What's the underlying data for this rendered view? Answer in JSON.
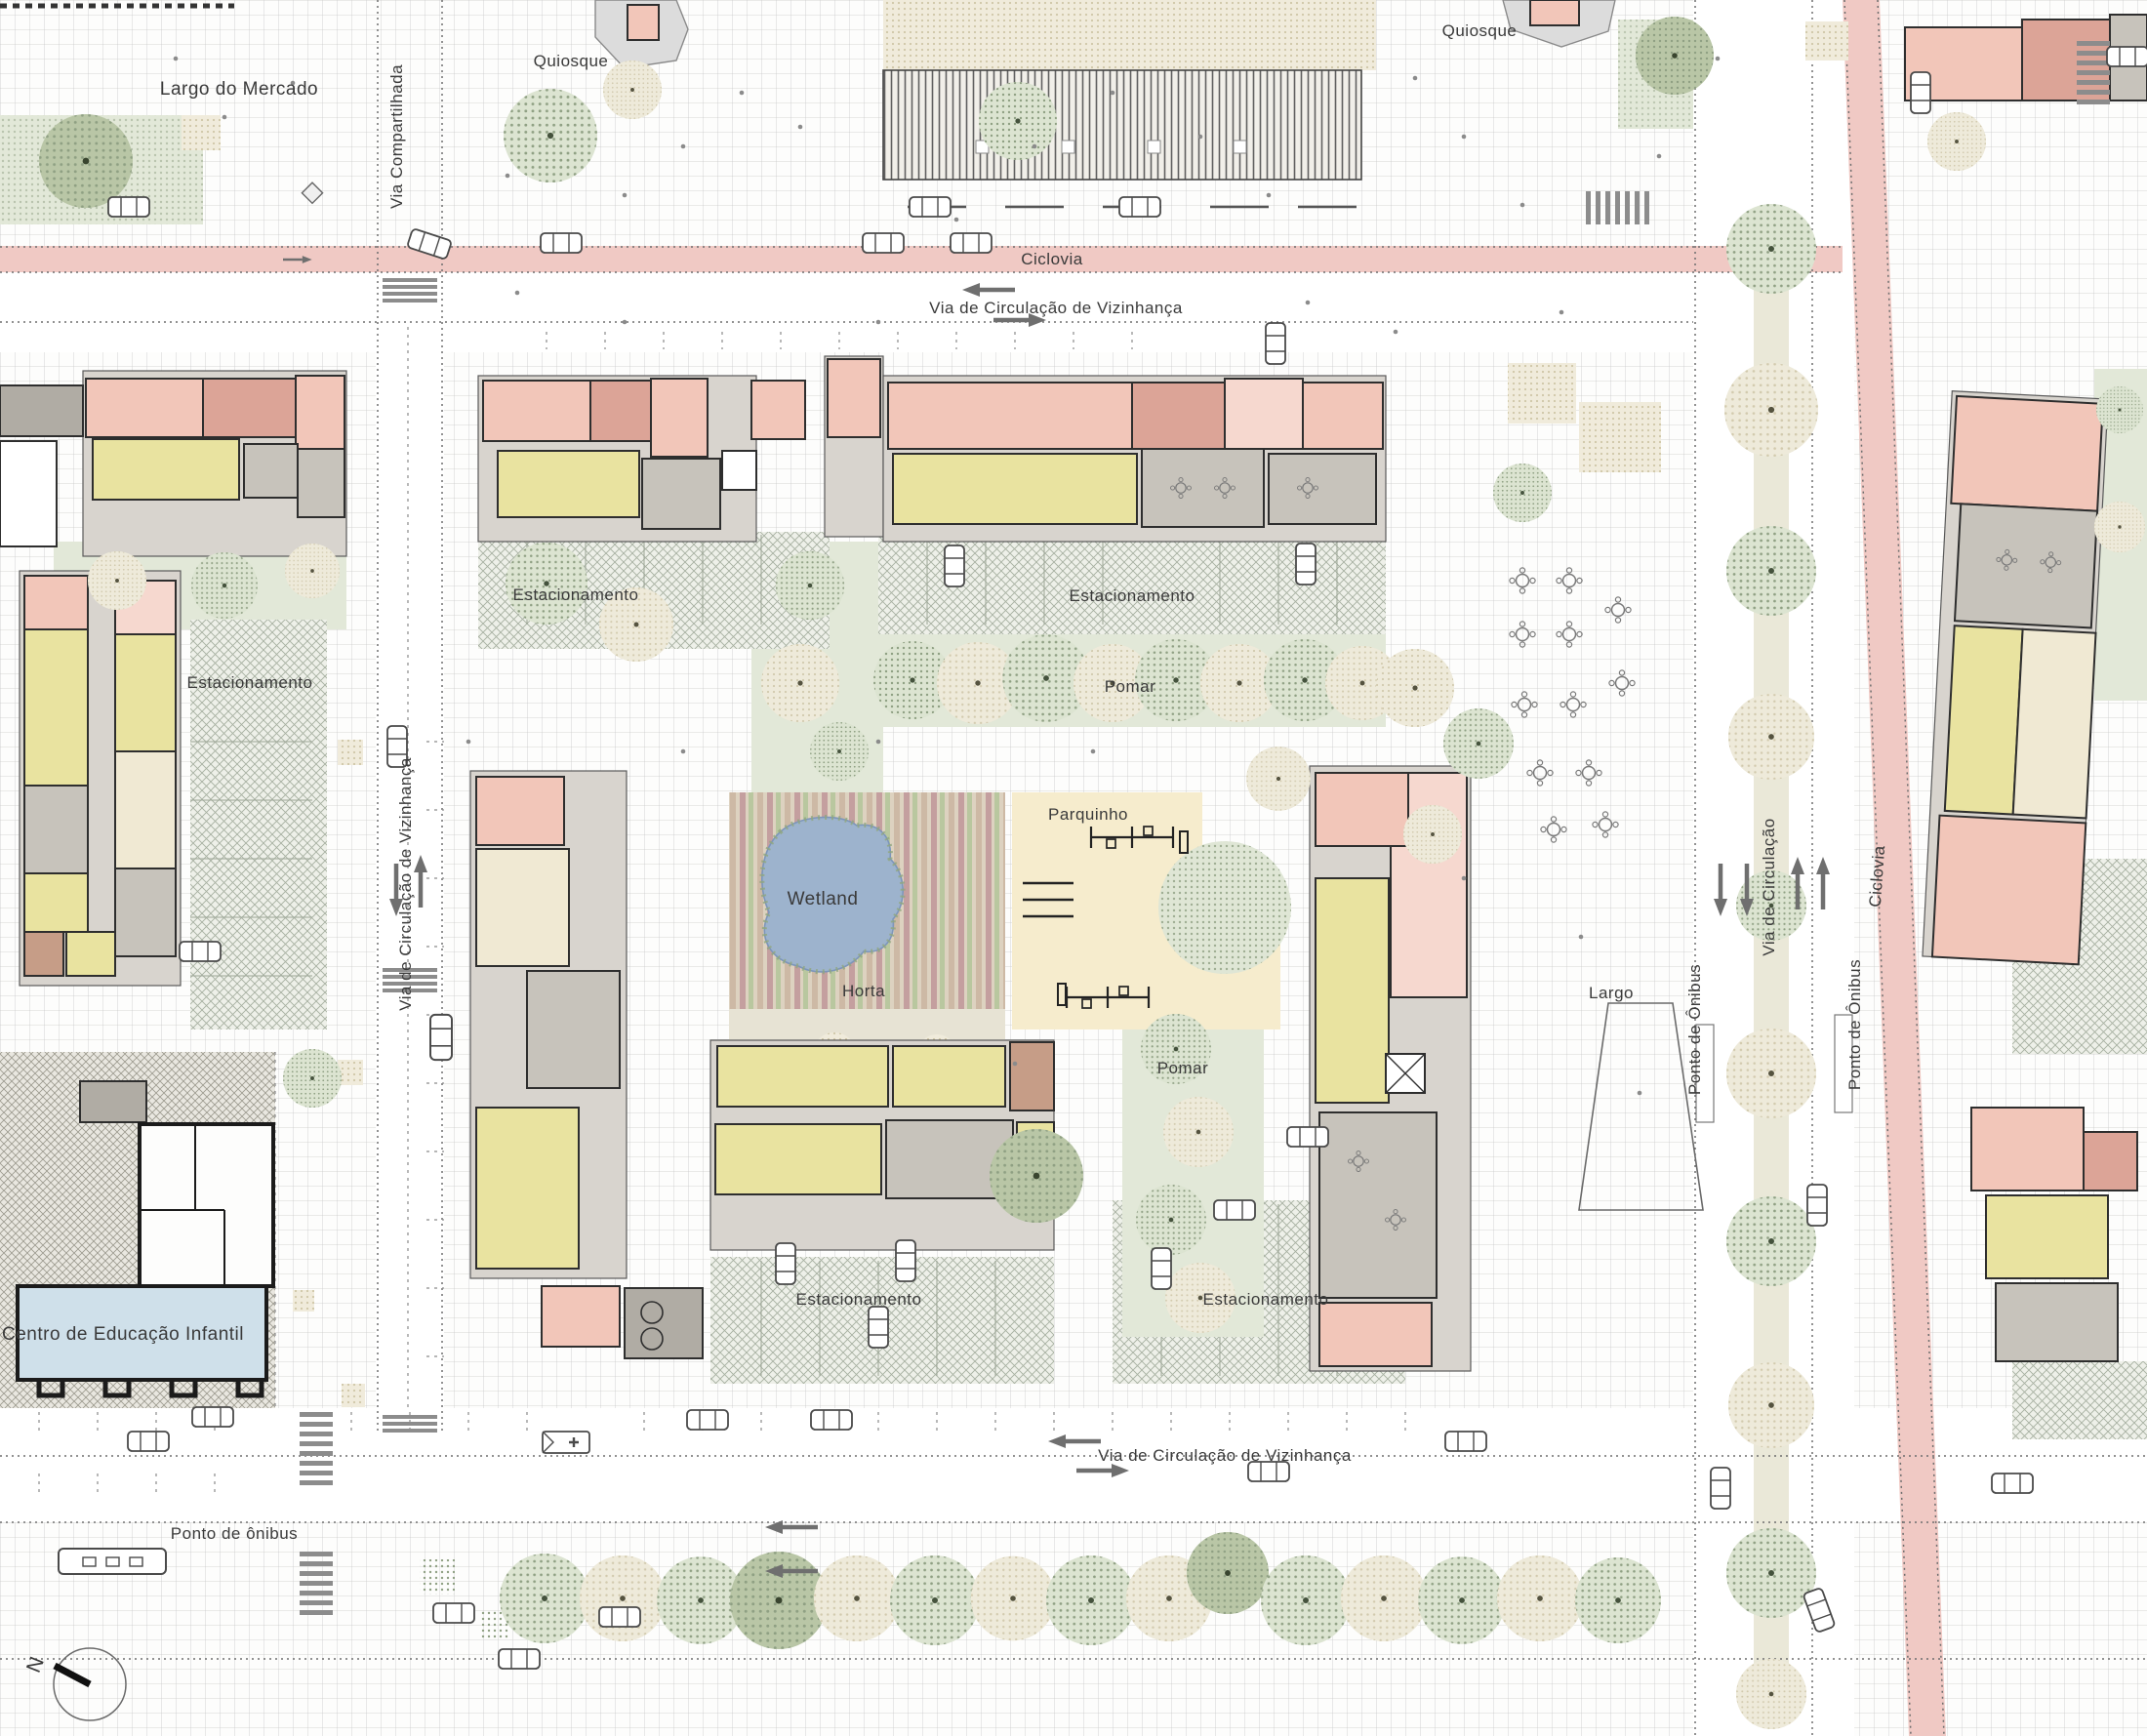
{
  "labels": {
    "largo_do_mercado": "Largo do Mercado",
    "via_compartilhada": "Via Compartilhada",
    "quiosque_left": "Quiosque",
    "quiosque_right": "Quiosque",
    "ciclovia_top": "Ciclovia",
    "via_vizinhanca_top": "Via de Circulação de Vizinhança",
    "estacionamento_inner_topleft": "Estacionamento",
    "estacionamento_inner_topcenter": "Estacionamento",
    "pomar_top": "Pomar",
    "estacionamento_left": "Estacionamento",
    "via_vizinhanca_left": "Via de Circulação de Vizinhança",
    "wetland": "Wetland",
    "horta": "Horta",
    "parquinho": "Parquinho",
    "pomar_center": "Pomar",
    "largo": "Largo",
    "ponto_onibus_right_west": "Ponto de Ônibus",
    "via_circulacao": "Via de Circulação",
    "ponto_onibus_right_east": "Ponto de Ônibus",
    "ciclovia_right": "Ciclovia",
    "estacionamento_bottom_west": "Estacionamento",
    "estacionamento_bottom_east": "Estacionamento",
    "centro_educacao_infantil": "Centro de Educação Infantil",
    "ponto_onibus_bottom": "Ponto de ônibus",
    "via_vizinhanca_bottom": "Via de Circulação de Vizinhança",
    "north": "N"
  },
  "colors": {
    "ciclovia_pink": "#f0c9c4",
    "building_salmon": "#f2c6b9",
    "building_salmon_dark": "#dca497",
    "unit_yellow": "#e9e3a0",
    "communal_gray": "#c7c3bb",
    "education_blue": "#cfe0ea",
    "wetland_blue": "#9db3cd",
    "lawn_green": "#dce4d1",
    "playground_beige": "#f6eccd"
  }
}
